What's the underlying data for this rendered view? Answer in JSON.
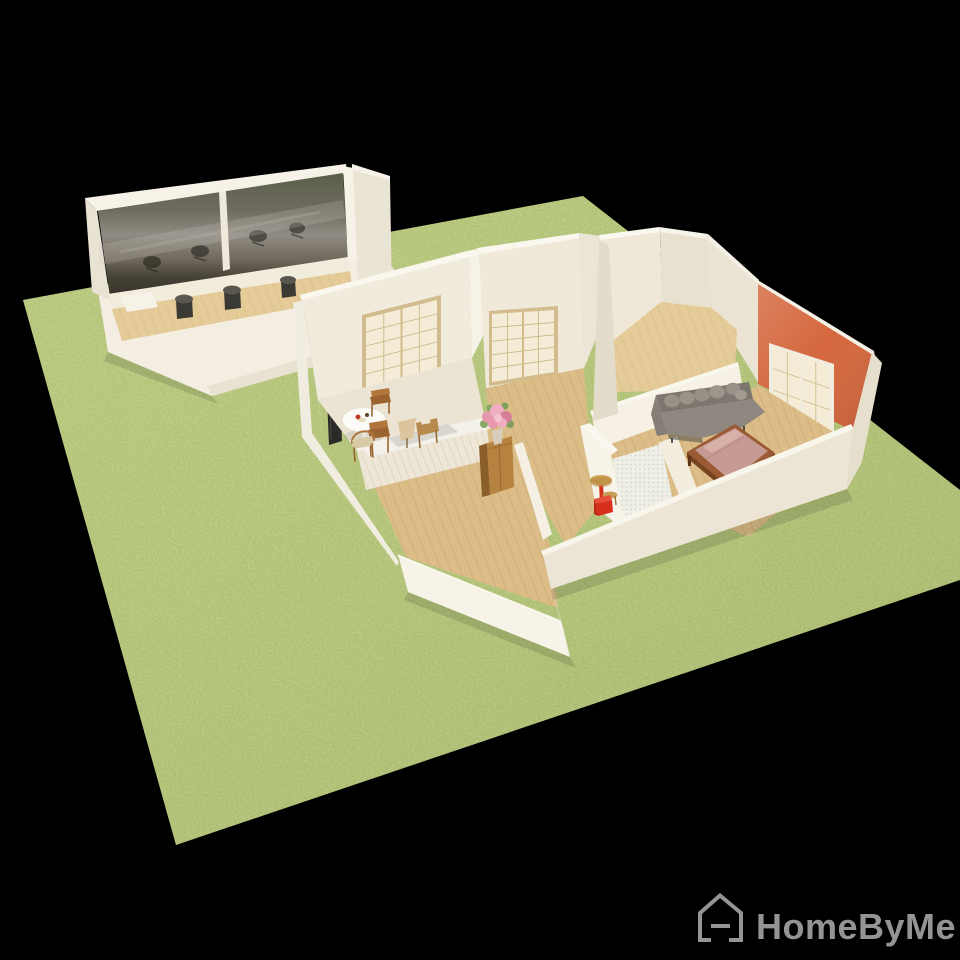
{
  "watermark": {
    "icon": "homebyme-house-icon",
    "label": "HomeByMe"
  },
  "scene": {
    "type": "3d-dollhouse-floorplan-render",
    "ground": "grass-lot-on-black",
    "buildings": [
      "annex-with-mirror-wall",
      "main-house"
    ],
    "annex": {
      "features": [
        "mirror-glass-wall",
        "office-chair-reflections",
        "wood-floor-strip"
      ],
      "bar_stool_count": 3
    },
    "main_house": {
      "rooms": [
        "kitchen-dining",
        "middle-room",
        "top-right-room",
        "living-bedroom",
        "hallway",
        "bathroom",
        "bottom-left-room"
      ],
      "furniture": [
        "dining-table",
        "dining-chairs",
        "kitchen-counter",
        "table-lamp",
        "storage-cabinet",
        "flower-bouquet",
        "tv-screen",
        "gray-sofa",
        "double-bed",
        "red-side-table",
        "red-stool"
      ],
      "window_count": 2,
      "sliding_door_panels": 2
    }
  },
  "colors": {
    "background": "#000000",
    "grass": "#aec16f",
    "grass_dark": "#8fa757",
    "grass_light": "#c6d28b",
    "wall_bright": "#f6f2e8",
    "wall_cream": "#efe9db",
    "wall_shade": "#e6dfcf",
    "wall_dark": "#ddd5c3",
    "wall_top": "#faf7ef",
    "floor_wood": "#dcbd88",
    "floor_wood_light": "#e5cb98",
    "floor_pale": "#ebe4d3",
    "orange_wall": "#d4673e",
    "window_frame": "#d2bc8d",
    "window_pane": "#f4ecd6",
    "sofa_gray": "#8d8780",
    "sofa_gray_dark": "#7c766e",
    "bed_pink": "#c69b94",
    "bed_pink_light": "#d7b0a8",
    "bed_frame": "#9a5a33",
    "cabinet_wood": "#b5823f",
    "chair_wood": "#b0763c",
    "red_accent": "#d6301c",
    "tile_white": "#efeee7",
    "mirror_olive": "#5a5f49",
    "mirror_gray": "#918c83",
    "mirror_dark": "#353129",
    "stool_dark": "#3b3933",
    "logo_gray": "#949494"
  }
}
